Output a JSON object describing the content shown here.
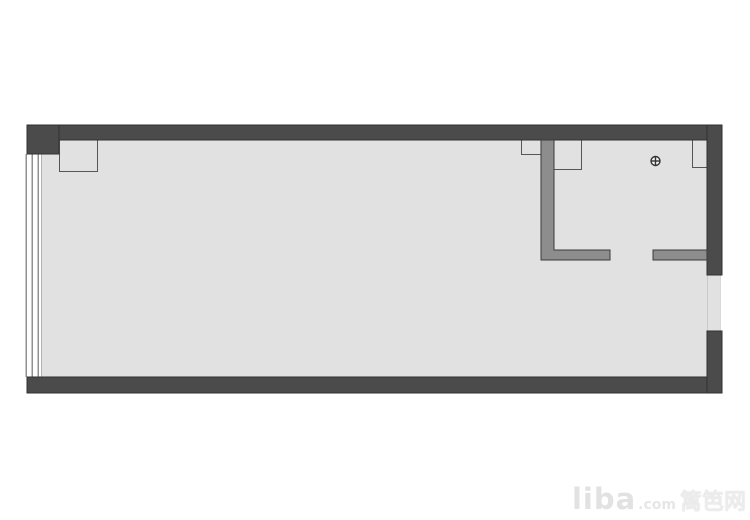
{
  "page": {
    "background": "#ffffff"
  },
  "palette": {
    "exterior_wall": "#4b4b4b",
    "exterior_wall_outline": "#303030",
    "interior_wall": "#8d8d8d",
    "interior_wall_outline": "#3c3c3c",
    "floor": "#e1e1e1",
    "column_outline": "#565656",
    "window_line": "#919191",
    "floor_edge": "#b3b3b3",
    "symbol": "#333333"
  },
  "floor_plan": {
    "canvas": {
      "width": 750,
      "height": 520
    },
    "floor": {
      "name": "floor-area",
      "x": 41,
      "y": 140,
      "w": 666,
      "h": 237
    },
    "exterior_walls": [
      {
        "name": "wall-top",
        "x": 27,
        "y": 125,
        "w": 695,
        "h": 15
      },
      {
        "name": "wall-bottom",
        "x": 27,
        "y": 377,
        "w": 695,
        "h": 16
      },
      {
        "name": "wall-right-upper",
        "x": 707,
        "y": 125,
        "w": 15,
        "h": 150
      },
      {
        "name": "wall-right-lower",
        "x": 707,
        "y": 331,
        "w": 15,
        "h": 62
      },
      {
        "name": "wall-corner-top-left",
        "x": 27,
        "y": 125,
        "w": 32,
        "h": 29
      }
    ],
    "interior_walls": [
      {
        "name": "partition-wall-l-shape",
        "points": "541,140 554,140 554,250 610,250 610,260 541,260"
      },
      {
        "name": "partition-wall-right-stub",
        "points": "653,250 707,250 707,260 653,260"
      }
    ],
    "columns": [
      {
        "name": "column-top-left",
        "x": 59,
        "y": 140,
        "w": 39,
        "h": 32,
        "border": "M59.5,140 L59.5,171.5 L97.5,171.5 L97.5,140"
      },
      {
        "name": "column-partition-left",
        "x": 521,
        "y": 140,
        "w": 20,
        "h": 15,
        "border": "M521.5,140 L521.5,154.5 L541,154.5"
      },
      {
        "name": "column-partition-right",
        "x": 554,
        "y": 140,
        "w": 28,
        "h": 30,
        "border": "M581.5,140 L581.5,169.5 L554,169.5"
      },
      {
        "name": "column-right",
        "x": 692,
        "y": 140,
        "w": 16,
        "h": 28,
        "border": "M692.5,140 L692.5,167.5 L707,167.5"
      }
    ],
    "window": {
      "name": "window-left",
      "lines_x": [
        26,
        32,
        38
      ],
      "y1": 154,
      "y2": 377,
      "edge_x": 41.5
    },
    "opening": {
      "name": "opening-right-wall",
      "x": 707,
      "y": 275,
      "w": 13,
      "h": 56
    },
    "drain_symbol": {
      "name": "drain-symbol",
      "cx": 655.5,
      "cy": 161,
      "r": 4.5
    }
  },
  "watermark": {
    "brand": "liba",
    "domain": ".com",
    "site_name": "篱笆网"
  }
}
